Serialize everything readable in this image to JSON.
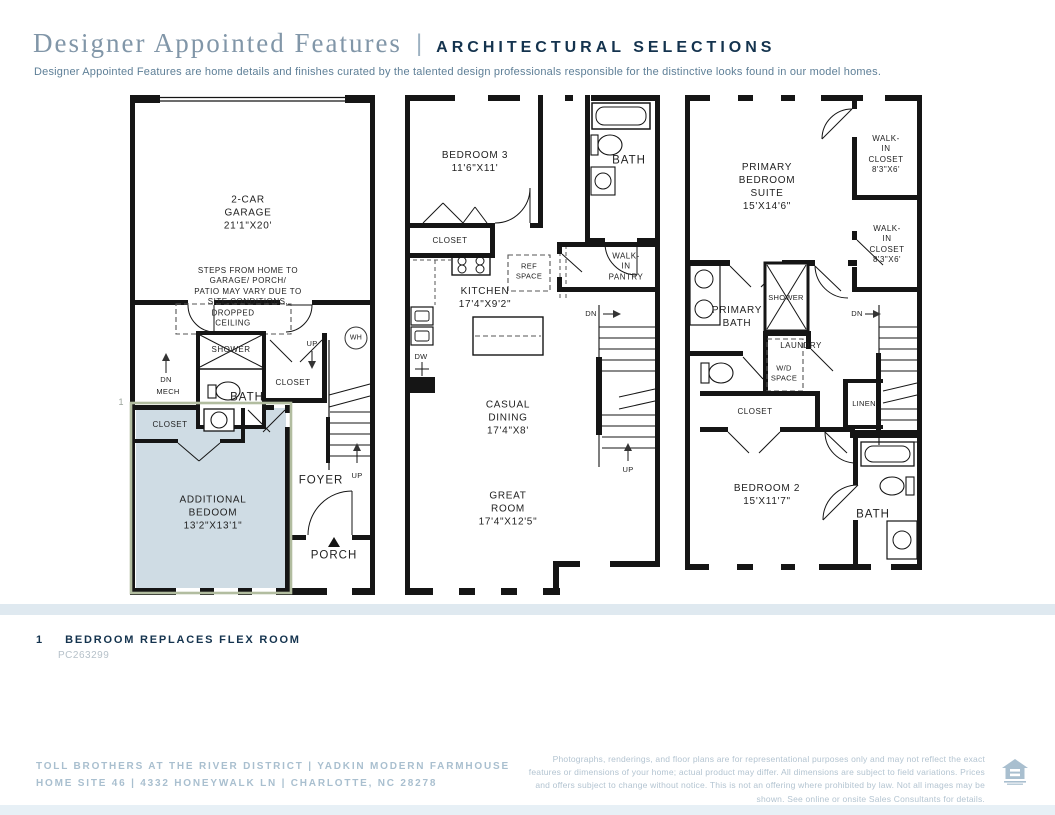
{
  "header": {
    "title": "Designer Appointed Features",
    "separator": "|",
    "selections_label": "ARCHITECTURAL SELECTIONS",
    "description": "Designer Appointed Features are home details and finishes curated by the talented design professionals responsible for the distinctive looks found in our model homes."
  },
  "plans": {
    "floor1": {
      "garage": "2-CAR\nGARAGE\n21'1\"X20'",
      "steps_note": "STEPS FROM HOME TO GARAGE/ PORCH/\nPATIO MAY VARY DUE TO SITE CONDITIONS.",
      "dropped_ceiling": "DROPPED\nCEILING",
      "shower": "SHOWER",
      "dn": "DN",
      "mech": "MECH",
      "bath": "BATH",
      "closet_hall": "CLOSET",
      "up_top": "UP",
      "wh": "WH",
      "closet_bedroom": "CLOSET",
      "additional_bedroom": "ADDITIONAL\nBEDOOM\n13'2\"X13'1\"",
      "marker": "1",
      "foyer": "FOYER",
      "up_stairs": "UP",
      "porch": "PORCH"
    },
    "floor2": {
      "bedroom3": "BEDROOM 3\n11'6\"X11'",
      "closet": "CLOSET",
      "bath": "BATH",
      "ref_space": "REF\nSPACE",
      "kitchen": "KITCHEN\n17'4\"X9'2\"",
      "walk_in_pantry": "WALK-IN\nPANTRY",
      "dw": "DW",
      "casual_dining": "CASUAL\nDINING\n17'4\"X8'",
      "great_room": "GREAT\nROOM\n17'4\"X12'5\"",
      "dn": "DN",
      "up": "UP"
    },
    "floor3": {
      "primary_suite": "PRIMARY\nBEDROOM\nSUITE\n15'X14'6\"",
      "walk_in_closet_1": "WALK-IN\nCLOSET\n8'3\"X6'",
      "walk_in_closet_2": "WALK-IN\nCLOSET\n8'3\"X6'",
      "primary_bath": "PRIMARY\nBATH",
      "shower": "SHOWER",
      "laundry": "LAUNDRY",
      "wd_space": "W/D\nSPACE",
      "dn": "DN",
      "linen": "LINEN",
      "closet": "CLOSET",
      "bedroom2": "BEDROOM 2\n15'X11'7\"",
      "bath": "BATH"
    }
  },
  "footnote": {
    "number": "1",
    "text": "BEDROOM REPLACES FLEX ROOM",
    "code": "PC263299"
  },
  "footer": {
    "line1": "TOLL BROTHERS AT THE RIVER DISTRICT  |  YADKIN MODERN FARMHOUSE",
    "line2": "HOME SITE 46  |  4332 HONEYWALK LN  |  CHARLOTTE, NC 28278",
    "disclaimer": "Photographs, renderings, and floor plans are for representational purposes only and may not reflect the exact features or dimensions of your home; actual product may differ. All dimensions are subject to field variations. Prices and offers subject to change without notice. This is not an offering where prohibited by law. Not all images may be shown. See online or onsite Sales Consultants for details."
  },
  "colors": {
    "navy": "#14334e",
    "title_serif": "#8196a8",
    "description_text": "#5e7f97",
    "footer_text": "#a9bfcf",
    "divider_band": "#dfe9f0",
    "highlight_fill": "#cfdce4",
    "highlight_border": "#b2bda0",
    "wall": "#151515"
  }
}
